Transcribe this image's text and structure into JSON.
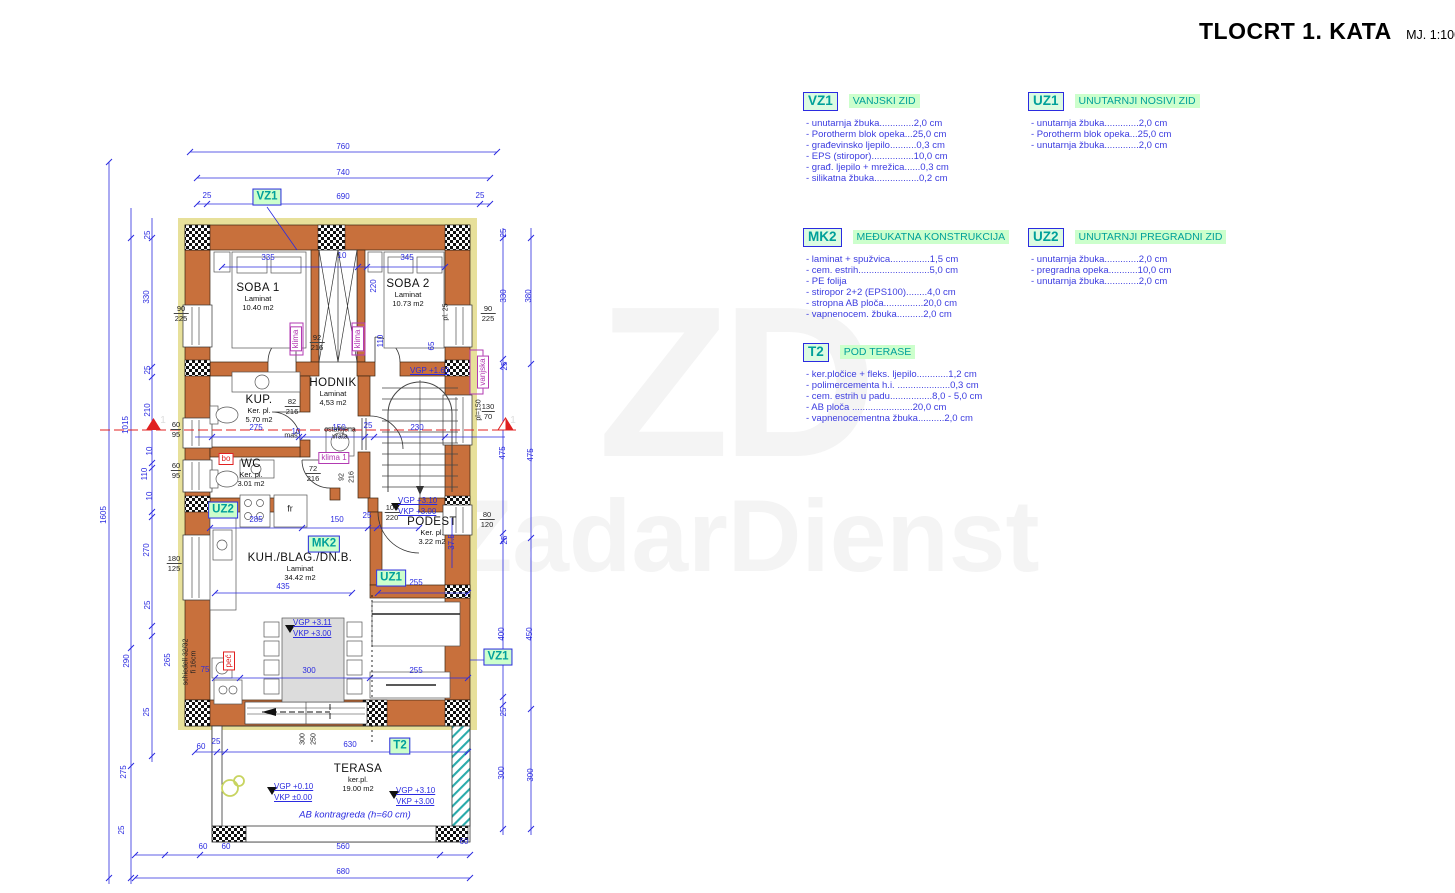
{
  "title": {
    "main": "TLOCRT 1. KATA",
    "scale": "MJ. 1:100"
  },
  "watermark": {
    "initials": "ZD",
    "name": "ZadarDienst"
  },
  "legend": [
    {
      "tag": "VZ1",
      "title": "VANJSKI ZID",
      "x": 803,
      "y": 92,
      "items": [
        "- unutarnja žbuka.............2,0 cm",
        "- Porotherm blok opeka...25,0 cm",
        "- građevinsko ljepilo..........0,3 cm",
        "- EPS (stiropor)................10,0 cm",
        "- građ. ljepilo + mrežica......0,3 cm",
        "- silikatna žbuka.................0,2 cm"
      ]
    },
    {
      "tag": "UZ1",
      "title": "UNUTARNJI NOSIVI ZID",
      "x": 1028,
      "y": 92,
      "items": [
        "- unutarnja žbuka.............2,0 cm",
        "- Porotherm blok opeka...25,0 cm",
        "- unutarnja žbuka.............2,0 cm"
      ]
    },
    {
      "tag": "MK2",
      "title": "MEĐUKATNA KONSTRUKCIJA",
      "x": 803,
      "y": 228,
      "items": [
        "- laminat + spužvica...............1,5 cm",
        "- cem. estrih...........................5,0 cm",
        "- PE folija",
        "- stiropor 2+2 (EPS100)........4,0 cm",
        "- stropna AB ploča...............20,0 cm",
        "- vapnenocem. žbuka..........2,0 cm"
      ]
    },
    {
      "tag": "UZ2",
      "title": "UNUTARNJI PREGRADNI ZID",
      "x": 1028,
      "y": 228,
      "items": [
        "- unutarnja žbuka.............2,0 cm",
        "- pregradna opeka...........10,0 cm",
        "- unutarnja žbuka.............2,0 cm"
      ]
    },
    {
      "tag": "T2",
      "title": "POD TERASE",
      "x": 803,
      "y": 343,
      "items": [
        "- ker.pločice + fleks. ljepilo............1,2 cm",
        "- polimercementa h.i. ....................0,3 cm",
        "- cem. estrih u padu................8,0 - 5,0 cm",
        "- AB ploča .......................20,0 cm",
        "- vapnenocementna žbuka..........2,0 cm"
      ]
    }
  ],
  "rooms": [
    {
      "n": "SOBA 1",
      "f": "Laminat",
      "a": "10.40 m2",
      "x": 258,
      "y": 282
    },
    {
      "n": "SOBA 2",
      "f": "Laminat",
      "a": "10.73 m2",
      "x": 408,
      "y": 278
    },
    {
      "n": "HODNIK",
      "f": "Laminat",
      "a": "4,53 m2",
      "x": 333,
      "y": 377
    },
    {
      "n": "KUP.",
      "f": "Ker. pl.",
      "a": "5.70 m2",
      "x": 259,
      "y": 394
    },
    {
      "n": "WC",
      "f": "Ker. pl.",
      "a": "3.01 m2",
      "x": 251,
      "y": 458
    },
    {
      "n": "PODEST",
      "f": "Ker. pl.",
      "a": "3.22 m2",
      "x": 432,
      "y": 516
    },
    {
      "n": "KUH./BLAG./DN.B.",
      "f": "Laminat",
      "a": "34.42 m2",
      "x": 300,
      "y": 552
    },
    {
      "n": "TERASA",
      "f": "ker.pl.",
      "a": "19.00 m2",
      "x": 358,
      "y": 763
    }
  ],
  "tags": [
    {
      "t": "VZ1",
      "x": 267,
      "y": 197
    },
    {
      "t": "UZ2",
      "x": 223,
      "y": 510
    },
    {
      "t": "MK2",
      "x": 324,
      "y": 544
    },
    {
      "t": "UZ1",
      "x": 391,
      "y": 578
    },
    {
      "t": "VZ1",
      "x": 498,
      "y": 657
    },
    {
      "t": "T2",
      "x": 400,
      "y": 746
    }
  ],
  "small_tags": [
    {
      "t": "klima",
      "x": 296,
      "y": 339,
      "r": 1,
      "c": "purple"
    },
    {
      "t": "klima",
      "x": 358,
      "y": 339,
      "r": 1,
      "c": "purple"
    },
    {
      "t": "klima 1",
      "x": 334,
      "y": 458,
      "c": "purple"
    },
    {
      "t": "vanjska",
      "x": 483,
      "y": 372,
      "r": 1,
      "c": "purple"
    },
    {
      "t": "bo",
      "x": 226,
      "y": 459,
      "c": "red"
    },
    {
      "t": "peć",
      "x": 229,
      "y": 661,
      "r": 1,
      "c": "red"
    }
  ],
  "levels": [
    {
      "ls": [
        "VGP +1.60"
      ],
      "x": 410,
      "y": 366
    },
    {
      "ls": [
        "VGP +3.10",
        "VKP +3.00"
      ],
      "x": 398,
      "y": 496
    },
    {
      "ls": [
        "VGP +3.11",
        "VKP +3.00"
      ],
      "x": 293,
      "y": 618
    },
    {
      "ls": [
        "VGP +0.10",
        "VKP ±0.00"
      ],
      "x": 274,
      "y": 782
    },
    {
      "ls": [
        "VGP +3.10",
        "VKP +3.00"
      ],
      "x": 396,
      "y": 786
    }
  ],
  "dims": [
    {
      "t": "760",
      "x": 343,
      "y": 147
    },
    {
      "t": "740",
      "x": 343,
      "y": 173
    },
    {
      "t": "25",
      "x": 207,
      "y": 196
    },
    {
      "t": "690",
      "x": 343,
      "y": 197
    },
    {
      "t": "25",
      "x": 480,
      "y": 196
    },
    {
      "t": "335",
      "x": 268,
      "y": 258
    },
    {
      "t": "10",
      "x": 342,
      "y": 256
    },
    {
      "t": "345",
      "x": 407,
      "y": 258
    },
    {
      "t": "1605",
      "x": 104,
      "y": 515,
      "r": 1
    },
    {
      "t": "1015",
      "x": 126,
      "y": 425,
      "r": 1
    },
    {
      "t": "25",
      "x": 148,
      "y": 235,
      "r": 1
    },
    {
      "t": "330",
      "x": 147,
      "y": 297,
      "r": 1
    },
    {
      "t": "25",
      "x": 148,
      "y": 370,
      "r": 1
    },
    {
      "t": "210",
      "x": 148,
      "y": 410,
      "r": 1
    },
    {
      "t": "10",
      "x": 150,
      "y": 451,
      "r": 1
    },
    {
      "t": "110",
      "x": 145,
      "y": 474,
      "r": 1
    },
    {
      "t": "10",
      "x": 150,
      "y": 496,
      "r": 1
    },
    {
      "t": "270",
      "x": 147,
      "y": 550,
      "r": 1
    },
    {
      "t": "25",
      "x": 148,
      "y": 605,
      "r": 1
    },
    {
      "t": "265",
      "x": 168,
      "y": 660,
      "r": 1
    },
    {
      "t": "290",
      "x": 127,
      "y": 661,
      "r": 1
    },
    {
      "t": "25",
      "x": 147,
      "y": 712,
      "r": 1
    },
    {
      "t": "275",
      "x": 124,
      "y": 772,
      "r": 1
    },
    {
      "t": "25",
      "x": 122,
      "y": 830,
      "r": 1
    },
    {
      "t": "380",
      "x": 529,
      "y": 296,
      "r": 1
    },
    {
      "t": "475",
      "x": 531,
      "y": 455,
      "r": 1
    },
    {
      "t": "450",
      "x": 530,
      "y": 634,
      "r": 1
    },
    {
      "t": "300",
      "x": 531,
      "y": 775,
      "r": 1
    },
    {
      "t": "25",
      "x": 504,
      "y": 233,
      "r": 1
    },
    {
      "t": "330",
      "x": 504,
      "y": 296,
      "r": 1
    },
    {
      "t": "25",
      "x": 505,
      "y": 366,
      "r": 1
    },
    {
      "t": "475",
      "x": 503,
      "y": 453,
      "r": 1
    },
    {
      "t": "25",
      "x": 505,
      "y": 540,
      "r": 1
    },
    {
      "t": "400",
      "x": 502,
      "y": 634,
      "r": 1
    },
    {
      "t": "25",
      "x": 504,
      "y": 712,
      "r": 1
    },
    {
      "t": "300",
      "x": 502,
      "y": 773,
      "r": 1
    },
    {
      "t": "220",
      "x": 374,
      "y": 286,
      "r": 1
    },
    {
      "t": "110",
      "x": 381,
      "y": 341,
      "r": 1
    },
    {
      "t": "65",
      "x": 432,
      "y": 346,
      "r": 1
    },
    {
      "t": "37.5",
      "x": 452,
      "y": 542,
      "r": 1
    },
    {
      "t": "275",
      "x": 256,
      "y": 428
    },
    {
      "t": "10",
      "x": 296,
      "y": 432
    },
    {
      "t": "150",
      "x": 339,
      "y": 428
    },
    {
      "t": "25",
      "x": 368,
      "y": 426
    },
    {
      "t": "230",
      "x": 417,
      "y": 428
    },
    {
      "t": "285",
      "x": 256,
      "y": 520
    },
    {
      "t": "150",
      "x": 337,
      "y": 520
    },
    {
      "t": "25",
      "x": 367,
      "y": 516
    },
    {
      "t": "435",
      "x": 283,
      "y": 587
    },
    {
      "t": "255",
      "x": 416,
      "y": 583
    },
    {
      "t": "75",
      "x": 205,
      "y": 670
    },
    {
      "t": "300",
      "x": 309,
      "y": 671
    },
    {
      "t": "255",
      "x": 416,
      "y": 671
    },
    {
      "t": "60",
      "x": 201,
      "y": 747
    },
    {
      "t": "25",
      "x": 216,
      "y": 742
    },
    {
      "t": "630",
      "x": 350,
      "y": 745
    },
    {
      "t": "60",
      "x": 203,
      "y": 847
    },
    {
      "t": "60",
      "x": 226,
      "y": 847
    },
    {
      "t": "560",
      "x": 343,
      "y": 847
    },
    {
      "t": "60",
      "x": 464,
      "y": 842
    },
    {
      "t": "680",
      "x": 343,
      "y": 872
    }
  ],
  "wall_labels": [
    {
      "a": "90",
      "b": "225",
      "x": 181,
      "y": 304
    },
    {
      "a": "90",
      "b": "225",
      "x": 488,
      "y": 304
    },
    {
      "a": "130",
      "b": "70",
      "x": 488,
      "y": 402
    },
    {
      "a": "80",
      "b": "120",
      "x": 487,
      "y": 510
    },
    {
      "a": "60",
      "b": "95",
      "x": 176,
      "y": 420
    },
    {
      "a": "60",
      "b": "95",
      "x": 176,
      "y": 461
    },
    {
      "a": "180",
      "b": "125",
      "x": 174,
      "y": 554
    },
    {
      "a": "100",
      "b": "220",
      "x": 392,
      "y": 503
    },
    {
      "a": "92",
      "b": "216",
      "x": 317,
      "y": 333
    },
    {
      "a": "82",
      "b": "216",
      "x": 292,
      "y": 397
    },
    {
      "a": "72",
      "b": "216",
      "x": 313,
      "y": 464
    }
  ],
  "vlabels": [
    {
      "t": "pl=150",
      "x": 479,
      "y": 410
    },
    {
      "t": "pl. 25",
      "x": 446,
      "y": 312
    },
    {
      "t": "92",
      "x": 342,
      "y": 477
    },
    {
      "t": "216",
      "x": 352,
      "y": 477
    },
    {
      "t": "300",
      "x": 303,
      "y": 739
    },
    {
      "t": "250",
      "x": 314,
      "y": 739
    },
    {
      "t": "schiedell 32/32",
      "x": 186,
      "y": 662
    },
    {
      "t": "fi 16cm",
      "x": 194,
      "y": 662
    }
  ],
  "notes": [
    {
      "t": "maš",
      "x": 291,
      "y": 436
    },
    {
      "t": "ostakljena",
      "x": 340,
      "y": 430
    },
    {
      "t": "vrata",
      "x": 340,
      "y": 437
    },
    {
      "t": "fr",
      "x": 290,
      "y": 509,
      "c": "big"
    },
    {
      "t": "AB kontragreda (h=60 cm)",
      "x": 355,
      "y": 815,
      "c": "ab"
    },
    {
      "t": "1",
      "x": 163,
      "y": 421,
      "c": "ghost"
    },
    {
      "t": "1",
      "x": 513,
      "y": 421,
      "c": "ghost"
    }
  ]
}
